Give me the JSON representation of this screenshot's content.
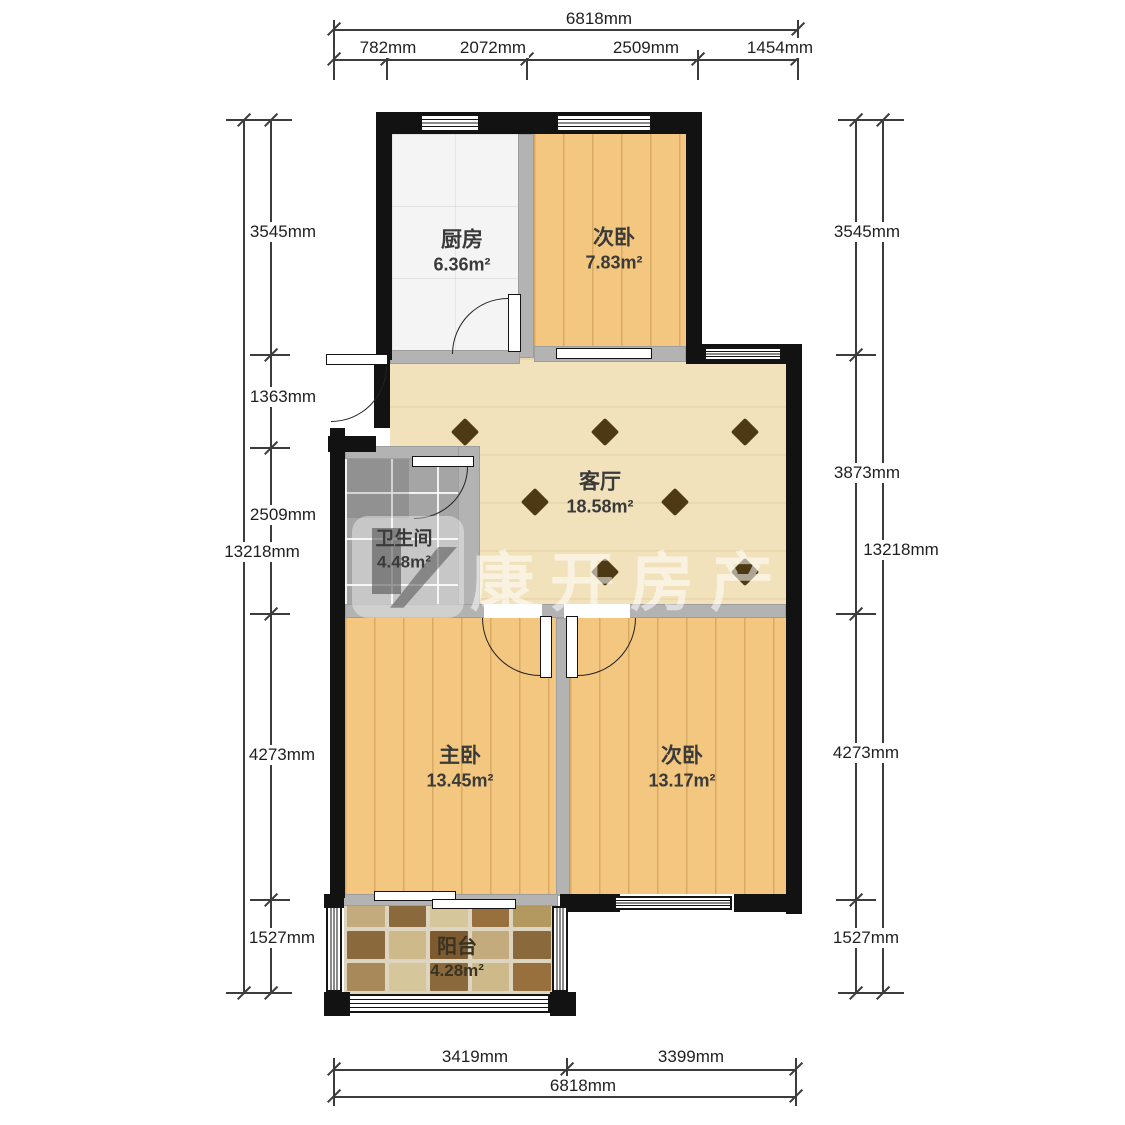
{
  "watermark": {
    "text": "康开房产",
    "logo_icon": "kangkai-building-logo"
  },
  "rooms": {
    "kitchen": {
      "name": "厨房",
      "area": "6.36m²"
    },
    "bedroom_top": {
      "name": "次卧",
      "area": "7.83m²"
    },
    "living": {
      "name": "客厅",
      "area": "18.58m²"
    },
    "bathroom": {
      "name": "卫生间",
      "area": "4.48m²"
    },
    "master": {
      "name": "主卧",
      "area": "13.45m²"
    },
    "bedroom_right": {
      "name": "次卧",
      "area": "13.17m²"
    },
    "balcony": {
      "name": "阳台",
      "area": "4.28m²"
    }
  },
  "dimensions": {
    "top": {
      "total": "6818mm",
      "segments": [
        "782mm",
        "2072mm",
        "2509mm",
        "1454mm"
      ]
    },
    "bottom": {
      "total": "6818mm",
      "segments": [
        "3419mm",
        "3399mm"
      ]
    },
    "left": {
      "total": "13218mm",
      "segments": [
        "3545mm",
        "1363mm",
        "2509mm",
        "4273mm",
        "1527mm"
      ]
    },
    "right": {
      "total": "13218mm",
      "segments": [
        "3545mm",
        "3873mm",
        "4273mm",
        "1527mm"
      ]
    }
  },
  "colors": {
    "wall": "#121212",
    "interior_wall": "#b3b3b3",
    "wood_floor": "#f3c77f",
    "living_floor": "#f1e2bb",
    "kitchen_floor": "#f4f4f4",
    "bathroom_floor": "#a5a5a5",
    "balcony_tile_dark": "#8a6a3c",
    "balcony_tile_light": "#d6c69b",
    "floor_diamond": "#4d3a14",
    "watermark": "#ffffff"
  }
}
